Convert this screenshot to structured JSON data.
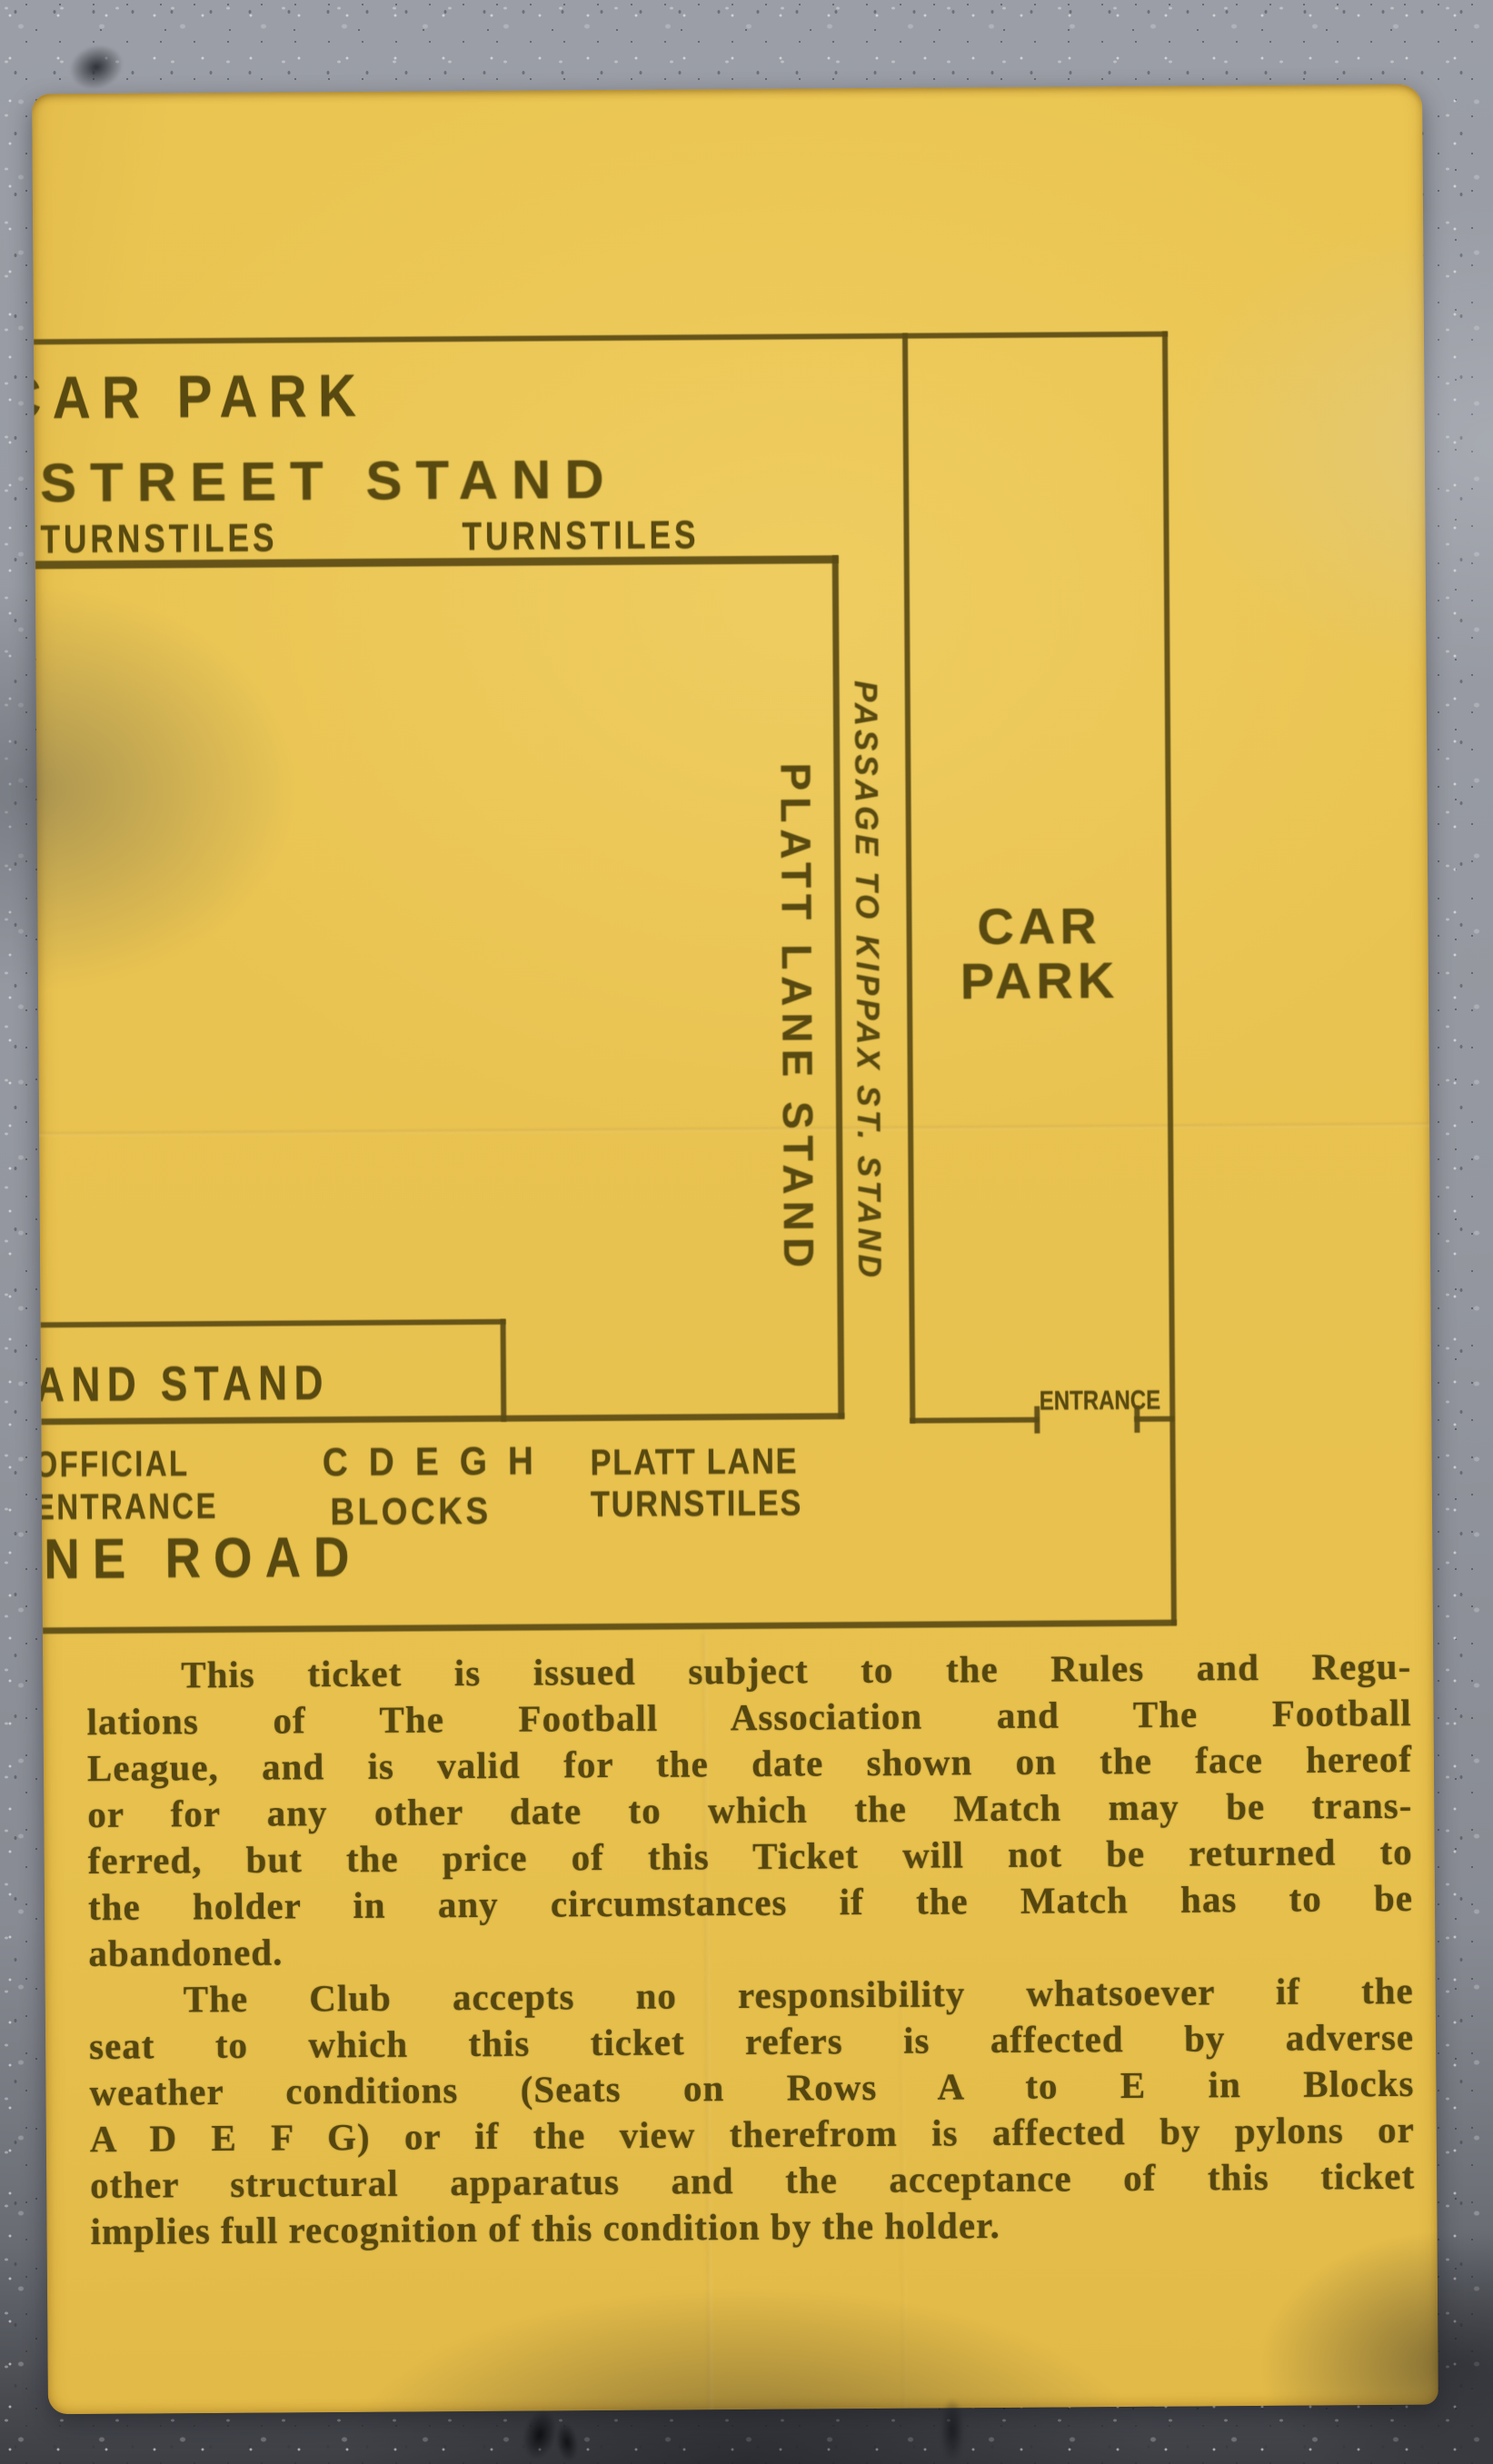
{
  "scene": {
    "background": "grey speckled stone",
    "stone_color": "#90939b",
    "paper_color": "#e9c351",
    "ink_color": "#584910"
  },
  "ticket": {
    "map": {
      "car_park_top_label": "CAR PARK",
      "street_stand_label": "STREET STAND",
      "turnstiles_left_label": "TURNSTILES",
      "turnstiles_right_label": "TURNSTILES",
      "platt_lane_stand_label": "PLATT LANE STAND",
      "passage_label": "PASSAGE TO KIPPAX ST. STAND",
      "car_park_right_line1": "CAR",
      "car_park_right_line2": "PARK",
      "entrance_label": "ENTRANCE",
      "stand_box_label": "AND STAND",
      "official_line1": "OFFICIAL",
      "official_line2": "ENTRANCE",
      "blocks_line1": "C D E G H",
      "blocks_line2": "BLOCKS",
      "platt_turnstiles_line1": "PLATT LANE",
      "platt_turnstiles_line2": "TURNSTILES",
      "road_label": "NE ROAD"
    },
    "terms": {
      "lines": [
        "This ticket is issued subject to the Rules and Regu-",
        "lations of The Football Association and The Football",
        "League, and is valid for the date shown on the face hereof",
        "or for any other date to which the Match may be trans-",
        "ferred, but the price of this Ticket will not be returned to",
        "the holder in any circumstances if the Match has to be",
        "abandoned.",
        "The Club accepts no responsibility whatsoever if the",
        "seat to which this ticket refers is affected by adverse",
        "weather conditions (Seats on Rows A to E in Blocks",
        "A D E F G) or if the view therefrom is affected by pylons or",
        "other structural apparatus and the acceptance of this ticket",
        "implies full recognition of this condition by the holder."
      ]
    }
  }
}
